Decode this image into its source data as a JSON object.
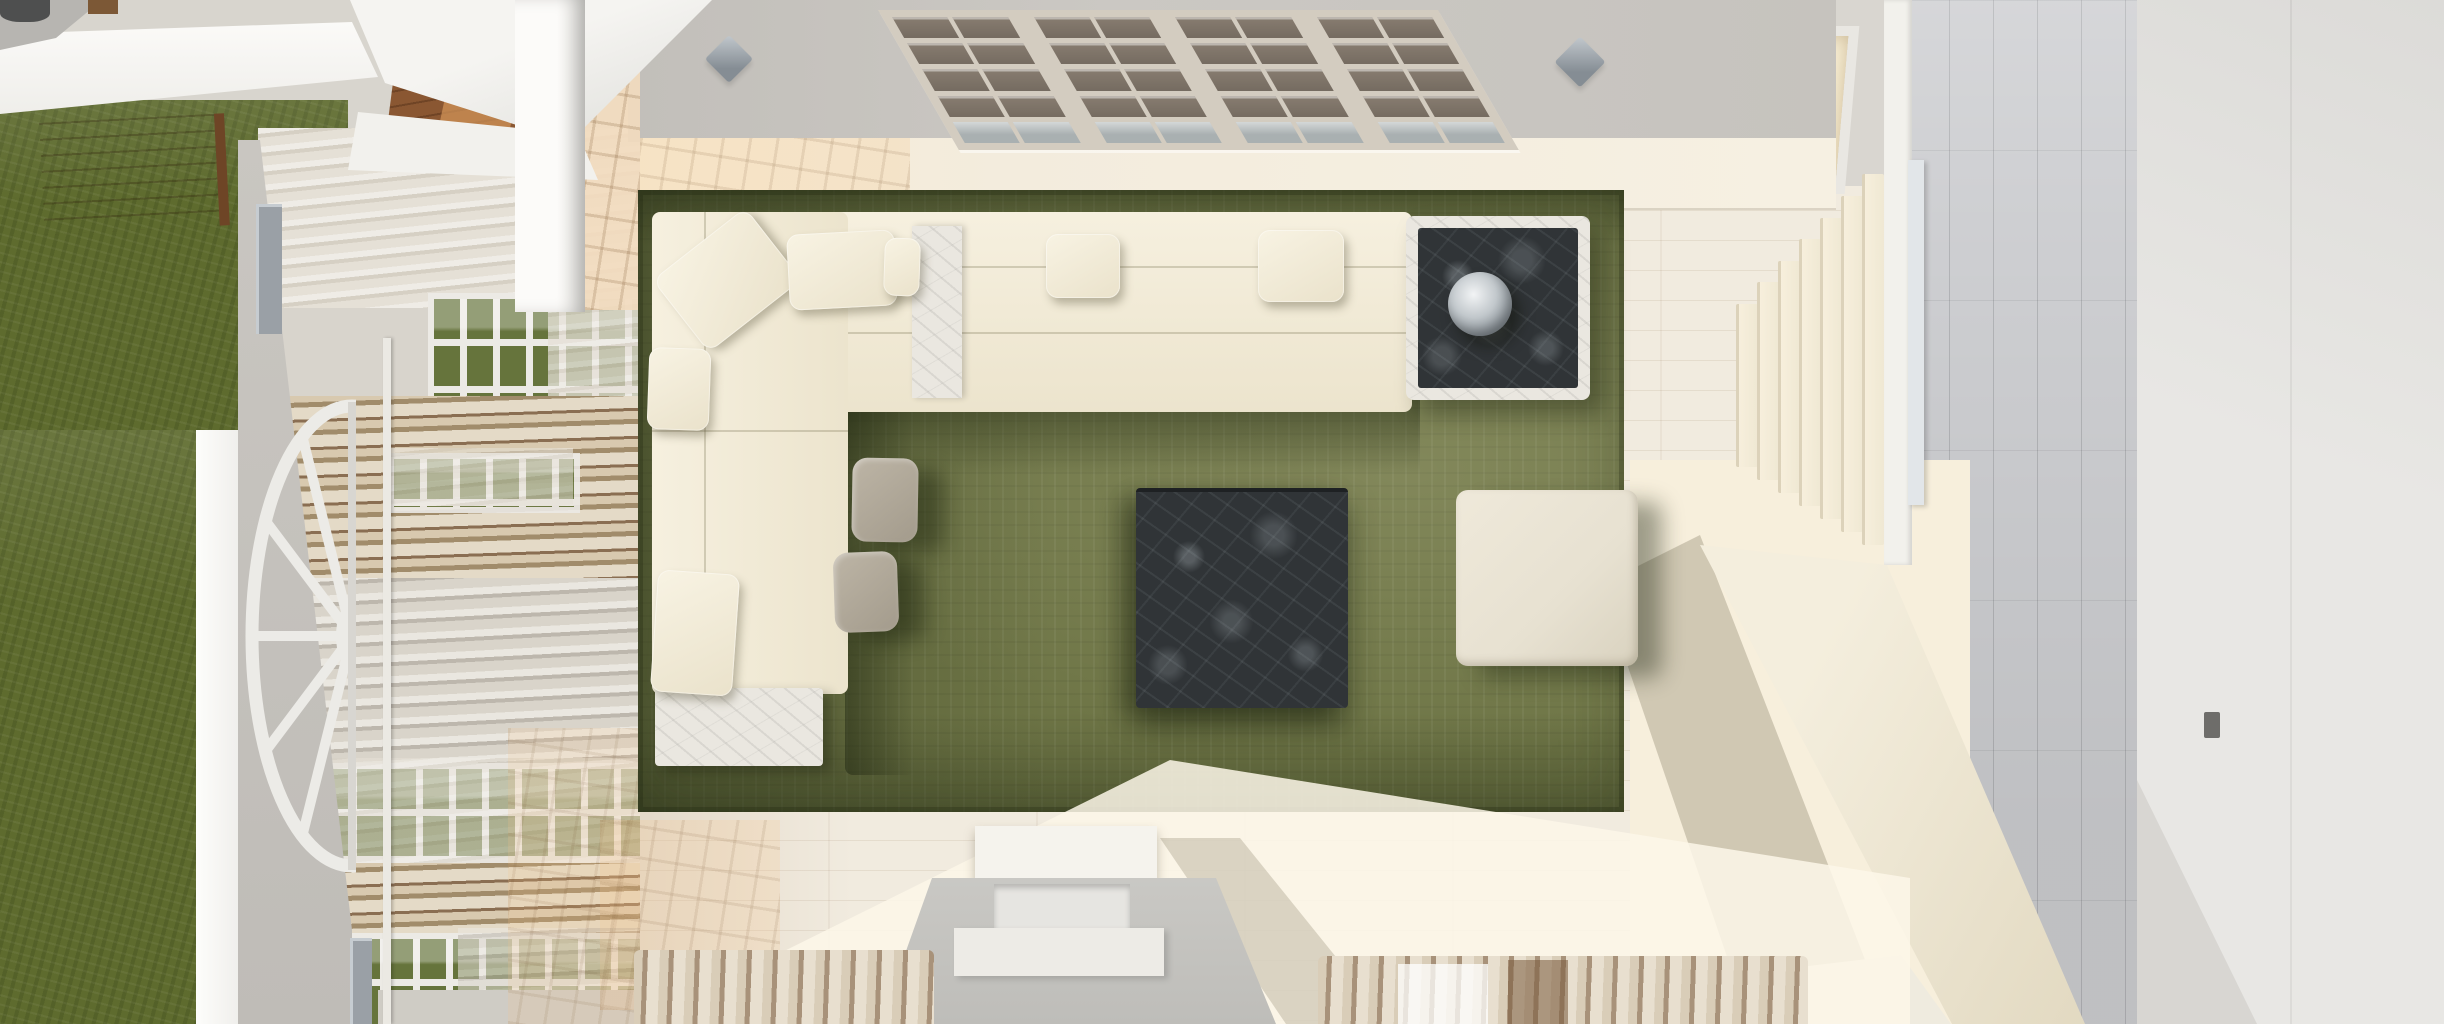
{
  "scene": {
    "description": "Top-down 3D architectural render of a bright living room with cream sectional sofa on an olive green rug, dark marble tables, whitewashed plank flooring, window wall with sheer curtains and lawn outside on the left, staircase and gray plank landing on the right, fireplace and curtained wall at the bottom",
    "room": "living-room",
    "view": "top-down-render",
    "visible_text": []
  },
  "labels": {
    "lawn": "Green lawn outside",
    "deck_table": "Wooden deck table",
    "pergola": "White pergola / roof edge",
    "hall_floor": "Warm wood hall floor",
    "window_wall": "Window wall with sheer curtains",
    "fan_window": "Half-round fan window decor",
    "wall_frame": "Gray wall bracket",
    "curtain_pole": "Curtain pole",
    "shelf_grid": "Gridded divider shelf",
    "sconce": "Wall sconce",
    "top_band": "Whitewashed wall cap",
    "rug": "Olive green area rug",
    "sofa": "Cream sectional sofa",
    "marble_console": "White marble console insert",
    "chaise_base": "White marble chaise base",
    "pillow": "Throw pillow",
    "pouf": "Gray fabric pouf",
    "coffee_table": "Dark marble coffee table",
    "side_table": "Dark marble side table",
    "sphere": "Glass sphere decor",
    "ottoman": "Cream ottoman",
    "fireplace": "Fireplace block",
    "bottom_curtain": "Draped curtain band",
    "stairs": "Staircase treads",
    "niche": "Lit stair niche",
    "railing": "Stair railing band",
    "landing": "Gray plank landing",
    "right_wall": "Stairwell wall",
    "door_edge": "Door edge strip",
    "floor": "Whitewashed plank floor"
  },
  "palette": {
    "grass": "#5e6b2e",
    "floor": "#f1ebdf",
    "gray_plank": "#cdced1",
    "wall_gray": "#c6c3be",
    "band": "#f3ecdd",
    "rug": "#6e7546",
    "sofa": "#f2ebd8",
    "pouf": "#b3ab9d",
    "marble_dark": "#33373a",
    "marble_white": "#eae7e0",
    "ottoman": "#e7e1d1",
    "stair_sun": "#f7efdc",
    "railing": "#ece4d2",
    "curtain_tan": "#b49a7d",
    "window_green": "#66743c",
    "sconce": "#9aa1a7",
    "wood": "#8a5732",
    "wood_light": "#cf9257",
    "shelf_frame": "#d3ccc0",
    "shelf_cell": "#857a6e",
    "niche_glow": "#f7ecd0",
    "right_wall": "#e8e7e4"
  },
  "shelf": {
    "panels": 4,
    "cols_per_panel": 2,
    "rows": 5
  },
  "staircase": {
    "tread_count": 7
  },
  "counts": {
    "pillows": 7,
    "poufs": 2,
    "sconces": 2,
    "bottom_curtains": 2,
    "window_strips": 4
  }
}
